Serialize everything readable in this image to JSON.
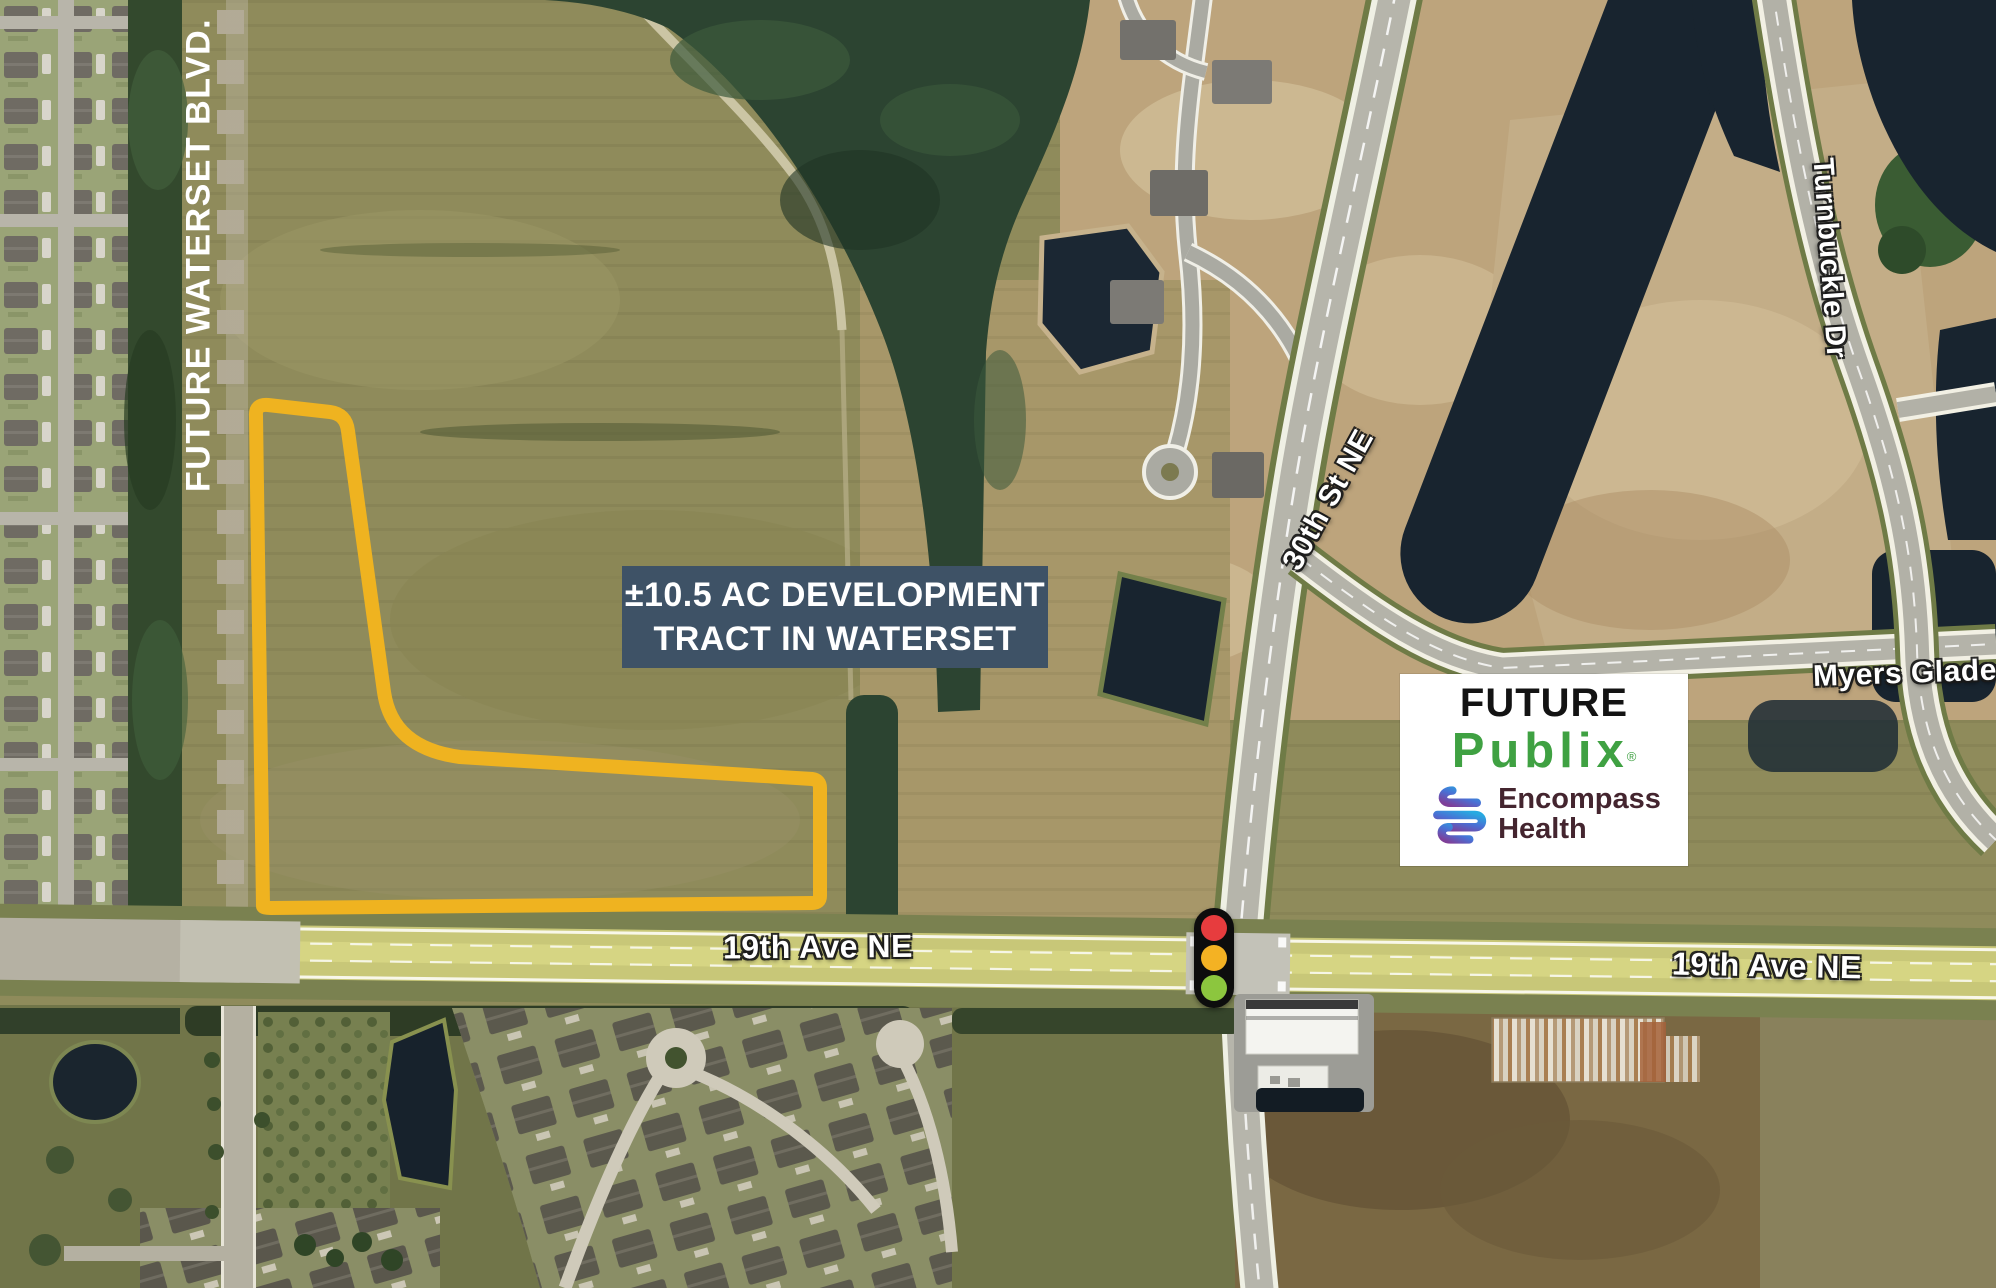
{
  "annotations": {
    "blvd": "FUTURE WATERSET BLVD.",
    "tract_line1": "±10.5 AC DEVELOPMENT",
    "tract_line2": "TRACT IN WATERSET",
    "road_30th": "30th St NE",
    "road_turnbuckle": "Turnbuckle Dr",
    "road_myers": "Myers Glade Ave",
    "road_19th_west": "19th Ave NE",
    "road_19th_east": "19th Ave NE"
  },
  "tenant_card": {
    "heading": "FUTURE",
    "publix_wordmark": "Publix",
    "publix_registered": "®",
    "encompass_line1": "Encompass",
    "encompass_line2": "Health"
  },
  "colors": {
    "tract_outline": "#EFB320",
    "tract_label_box_bg": "#3E5266",
    "blvd_dash": "#B3AB97",
    "publix_green": "#3FA142",
    "encompass_text": "#44252F",
    "encompass_gradient_start": "#7F3F98",
    "encompass_gradient_mid": "#4A6FD4",
    "encompass_gradient_end": "#27AAE1",
    "traffic_red": "#E73C3E",
    "traffic_amber": "#F4B223",
    "traffic_green": "#8CC63E"
  }
}
